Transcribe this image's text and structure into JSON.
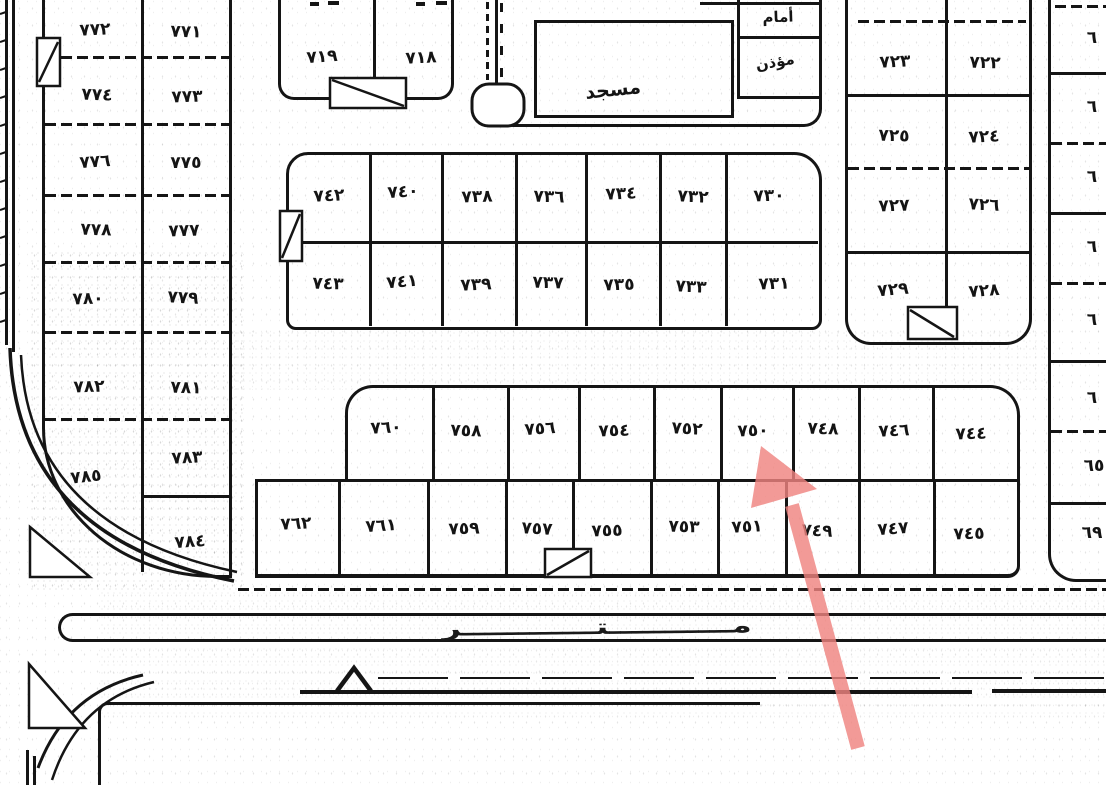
{
  "blocks": {
    "left": {
      "cells": [
        "٧٧٢",
        "٧٧١",
        "٧٧٤",
        "٧٧٣",
        "٧٧٦",
        "٧٧٥",
        "٧٧٨",
        "٧٧٧",
        "٧٨٠",
        "٧٧٩",
        "٧٨٢",
        "٧٨١",
        "٧٨٥",
        "٧٨٣",
        "٧٨٤"
      ]
    },
    "north": {
      "cells": [
        "٧١٩",
        "٧١٨"
      ]
    },
    "mosque": {
      "name": "مسجد",
      "imam": "أمام",
      "muezzin": "مؤذن"
    },
    "east": {
      "cells": [
        "٧٢٣",
        "٧٢٢",
        "٧٢٥",
        "٧٢٤",
        "٧٢٧",
        "٧٢٦",
        "٧٢٩",
        "٧٢٨"
      ]
    },
    "middle": {
      "top": [
        "٧٤٢",
        "٧٤٠",
        "٧٣٨",
        "٧٣٦",
        "٧٣٤",
        "٧٣٢",
        "٧٣٠"
      ],
      "bottom": [
        "٧٤٣",
        "٧٤١",
        "٧٣٩",
        "٧٣٧",
        "٧٣٥",
        "٧٣٣",
        "٧٣١"
      ]
    },
    "south": {
      "top": [
        "٧٦٠",
        "٧٥٨",
        "٧٥٦",
        "٧٥٤",
        "٧٥٢",
        "٧٥٠",
        "٧٤٨",
        "٧٤٦",
        "٧٤٤"
      ],
      "bottom": [
        "٧٦٢",
        "٧٦١",
        "٧٥٩",
        "٧٥٧",
        "٧٥٥",
        "٧٥٣",
        "٧٥١",
        "٧٤٩",
        "٧٤٧",
        "٧٤٥"
      ]
    },
    "east_strip": {
      "partials": [
        "٦",
        "٦",
        "٦",
        "٦",
        "٦",
        "٦",
        "٦٥",
        "٦٩"
      ]
    }
  },
  "road": {
    "label": "مـــــــــــتــــــــــــر"
  },
  "annotation": {
    "type": "arrow",
    "color": "#ef8480",
    "points_to_plot": "٧٥٠"
  }
}
